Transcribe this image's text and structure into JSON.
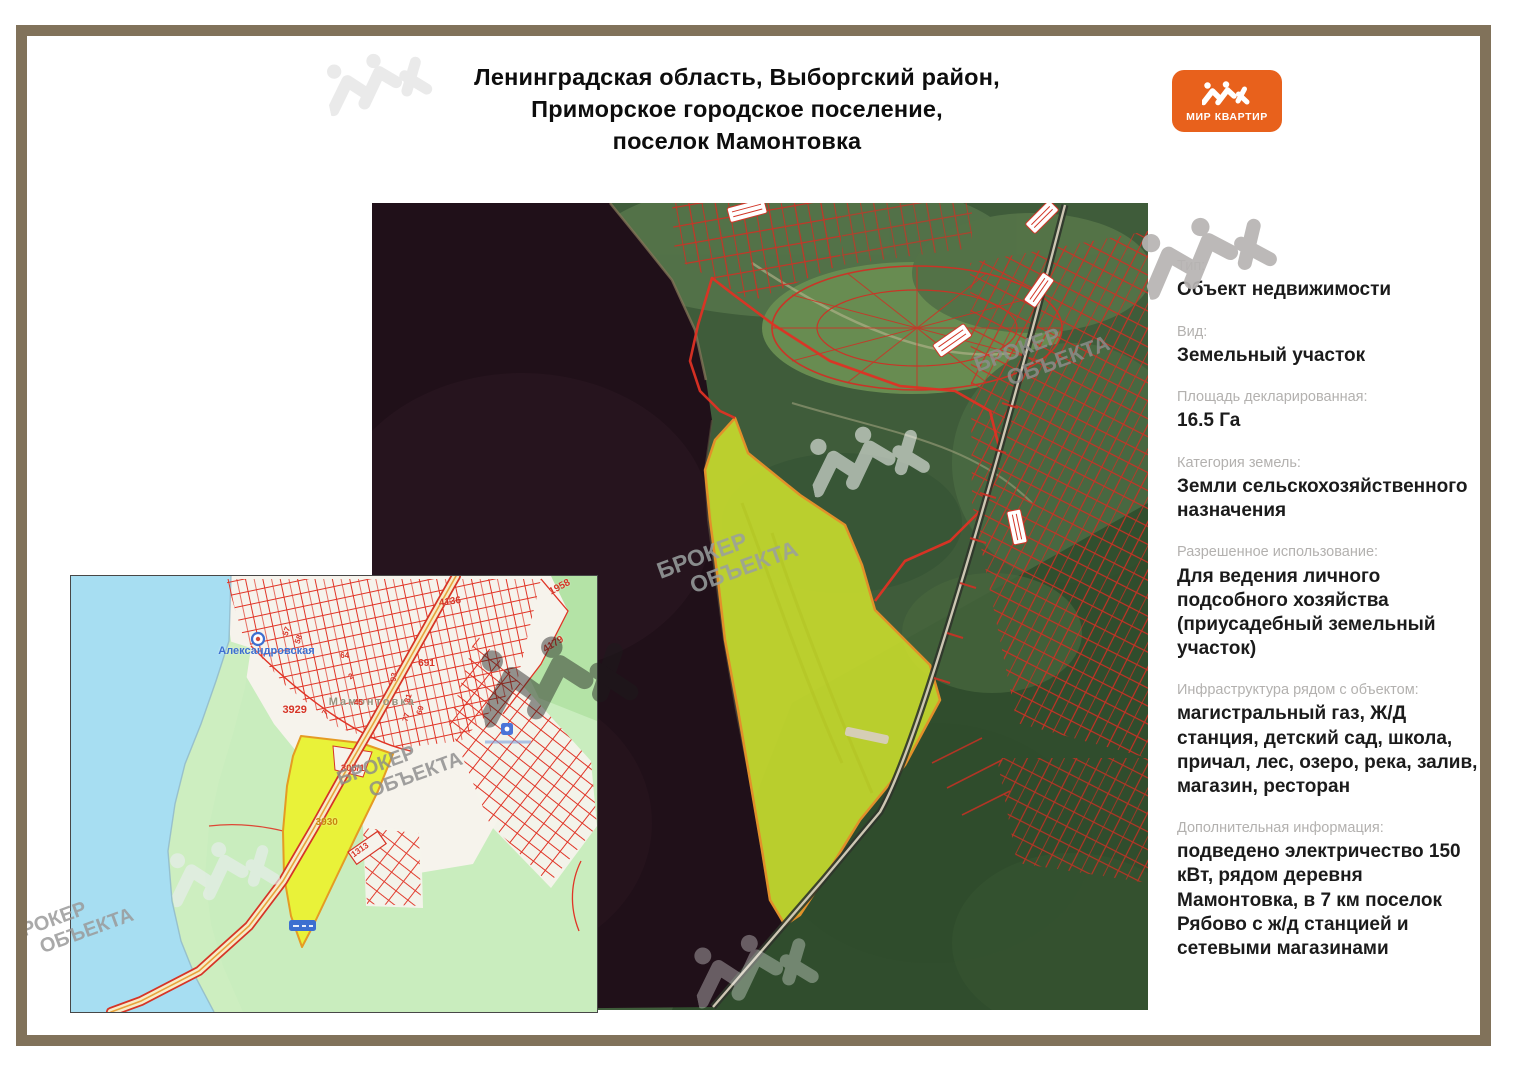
{
  "page": {
    "title_lines": [
      "Ленинградская область, Выборгский район,",
      "Приморское городское поселение,",
      "поселок Мамонтовка"
    ]
  },
  "logo": {
    "text": "МИР КВАРТИР",
    "color": "#e8611c"
  },
  "watermark": {
    "line1": "БРОКЕР",
    "line2": "ОБЪЕКТА"
  },
  "sidebar": {
    "fields": [
      {
        "label": "Тип:",
        "value": "Объект недвижимости"
      },
      {
        "label": "Вид:",
        "value": "Земельный участок"
      },
      {
        "label": "Площадь декларированная:",
        "value": "16.5 Га"
      },
      {
        "label": "Категория земель:",
        "value": "Земли сельскохозяйственного назначения"
      },
      {
        "label": "Разрешенное использование:",
        "value": "Для ведения личного подсобного хозяйства (приусадебный земельный участок)"
      },
      {
        "label": "Инфраструктура рядом с объектом:",
        "value": "магистральный газ, Ж/Д станция, детский сад, школа, причал, лес, озеро, река, залив, магазин, ресторан"
      },
      {
        "label": "Дополнительная информация:",
        "value": "подведено электричество 150 кВт, рядом деревня Мамонтовка, в 7 км поселок Рябово с ж/д станцией и сетевыми магазинами"
      }
    ]
  },
  "inset_map": {
    "station_label": "Александровская",
    "village_label": "Мамонтовка",
    "highlight_parcel_number": "3930",
    "labels": [
      {
        "text": "Александровская",
        "x": 28.0,
        "y": 15.8,
        "color": "#3d6fd0",
        "size": 11,
        "rot": 0,
        "ls": 0
      },
      {
        "text": "Мамонтовка",
        "x": 49.0,
        "y": 27.6,
        "color": "#96937f",
        "size": 11,
        "rot": 0,
        "ls": 2
      },
      {
        "text": "3929",
        "x": 40.2,
        "y": 29.4,
        "color": "#d63426",
        "size": 11,
        "rot": 0,
        "ls": 0
      },
      {
        "text": "4136",
        "x": 70.0,
        "y": 5.0,
        "color": "#d63426",
        "size": 10,
        "rot": -8,
        "ls": 0
      },
      {
        "text": "1958",
        "x": 91.0,
        "y": 2.6,
        "color": "#d63426",
        "size": 10,
        "rot": -28,
        "ls": 0
      },
      {
        "text": "4179",
        "x": 90.0,
        "y": 15.8,
        "color": "#d63426",
        "size": 10,
        "rot": -32,
        "ls": 0
      },
      {
        "text": "691",
        "x": 66.0,
        "y": 18.8,
        "color": "#d63426",
        "size": 10,
        "rot": 0,
        "ls": 0
      },
      {
        "text": "305/1",
        "x": 51.3,
        "y": 43.0,
        "color": "#d63426",
        "size": 9.5,
        "rot": 0,
        "ls": 0
      },
      {
        "text": "3930",
        "x": 46.5,
        "y": 55.2,
        "color": "#c8870a",
        "size": 10,
        "rot": 0,
        "ls": 0
      },
      {
        "text": "1313",
        "x": 53.5,
        "y": 62.8,
        "color": "#d63426",
        "size": 8.5,
        "rot": -35,
        "ls": 0
      },
      {
        "text": "57",
        "x": 40.6,
        "y": 12.6,
        "color": "#d63426",
        "size": 8,
        "rot": -70,
        "ls": 0
      },
      {
        "text": "58",
        "x": 43.0,
        "y": 14.4,
        "color": "#d63426",
        "size": 8,
        "rot": -70,
        "ls": 0
      },
      {
        "text": "64",
        "x": 51.2,
        "y": 17.2,
        "color": "#d63426",
        "size": 8,
        "rot": 0,
        "ls": 0
      },
      {
        "text": "2",
        "x": 52.8,
        "y": 22.2,
        "color": "#d63426",
        "size": 8,
        "rot": -30,
        "ls": 0
      },
      {
        "text": "45",
        "x": 53.8,
        "y": 27.9,
        "color": "#d63426",
        "size": 8,
        "rot": 0,
        "ls": 0
      },
      {
        "text": "7",
        "x": 48.1,
        "y": 30.8,
        "color": "#d63426",
        "size": 8,
        "rot": -60,
        "ls": 0
      },
      {
        "text": "93",
        "x": 61.2,
        "y": 23.2,
        "color": "#d63426",
        "size": 8,
        "rot": -80,
        "ls": 0
      },
      {
        "text": "81",
        "x": 63.9,
        "y": 28.0,
        "color": "#d63426",
        "size": 8,
        "rot": -75,
        "ls": 0
      },
      {
        "text": "69",
        "x": 66.1,
        "y": 30.8,
        "color": "#d63426",
        "size": 8,
        "rot": -75,
        "ls": 0
      },
      {
        "text": "77",
        "x": 63.5,
        "y": 32.4,
        "color": "#d63426",
        "size": 8,
        "rot": -75,
        "ls": 0
      }
    ]
  }
}
